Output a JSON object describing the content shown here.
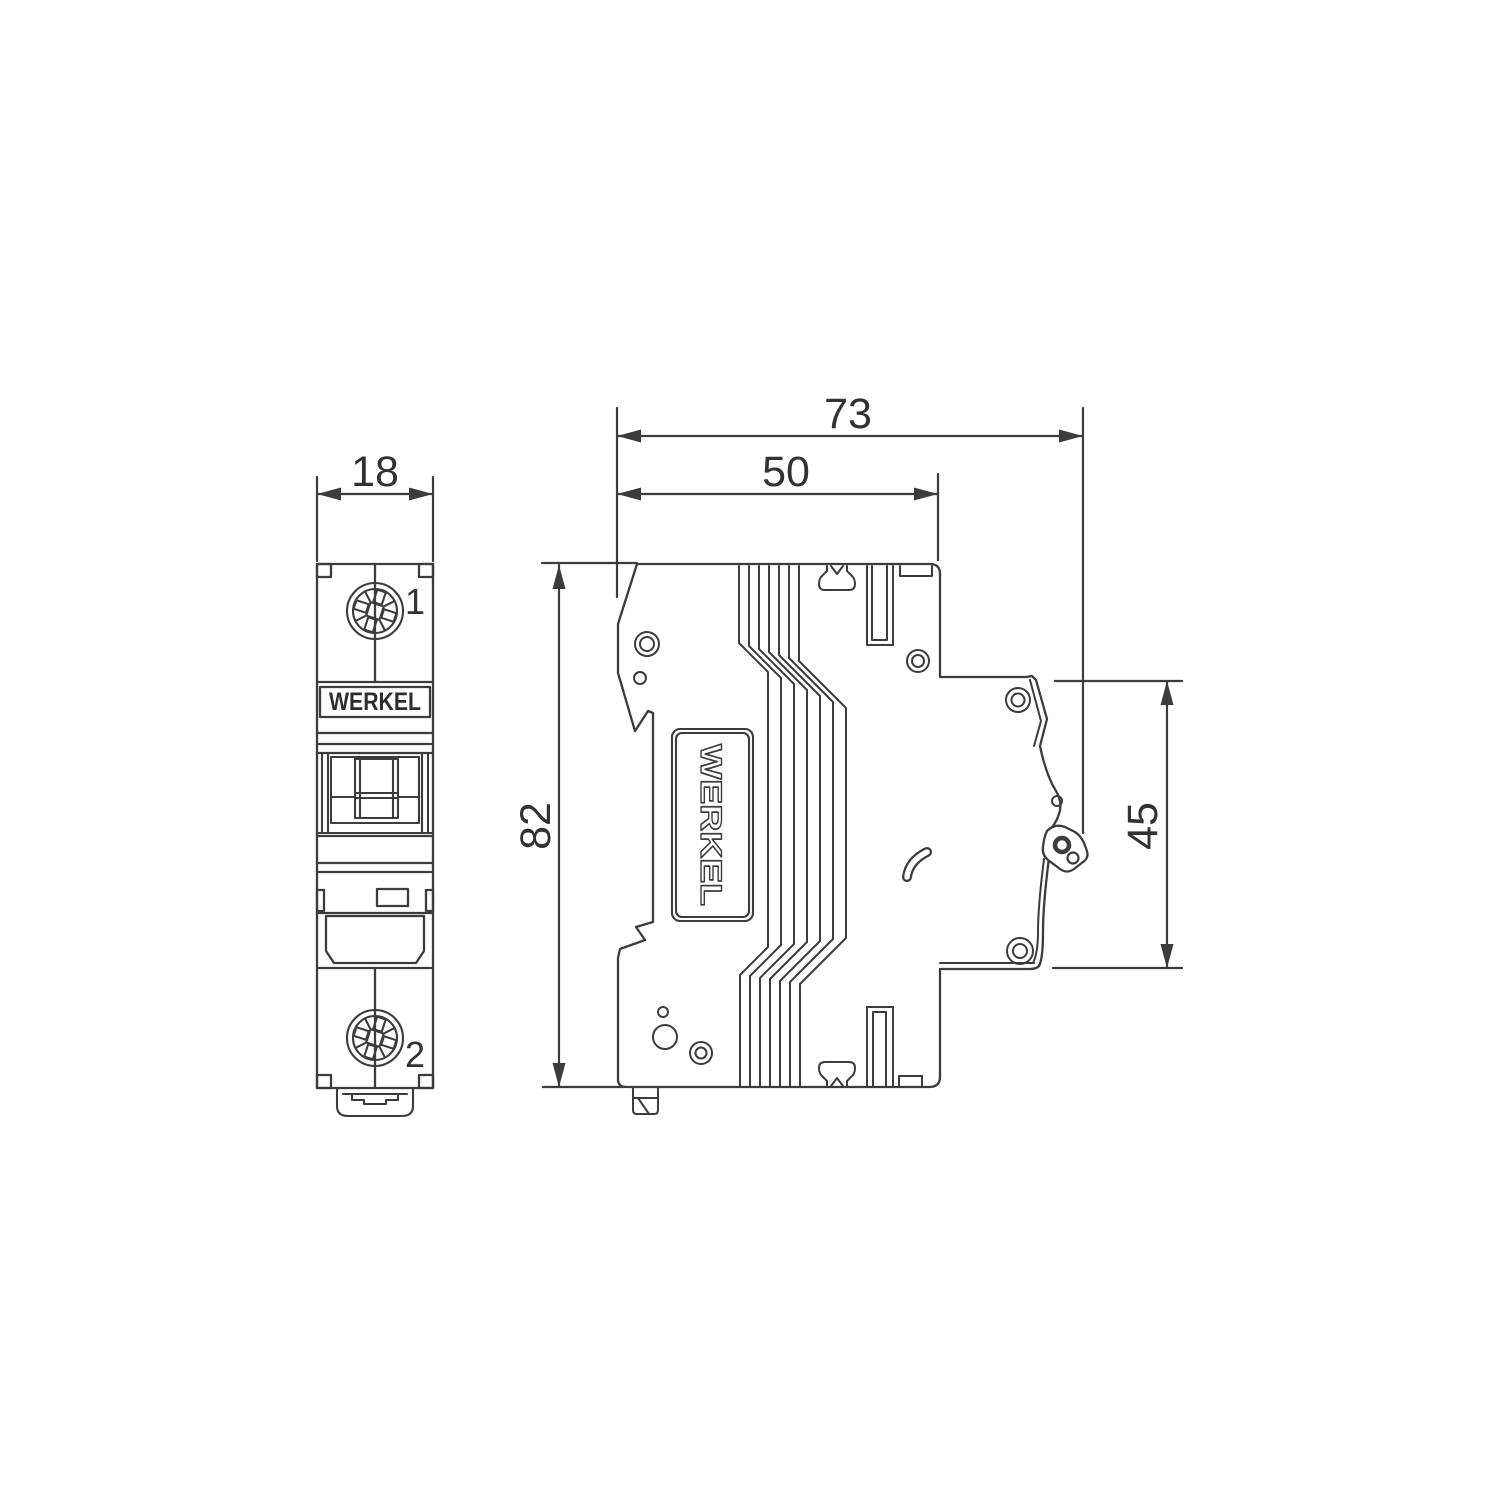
{
  "title": "WERKEL modular circuit breaker dimensional drawing",
  "brand": "WERKEL",
  "colors": {
    "line": "#3c3c3c",
    "text": "#323232",
    "background": "#ffffff"
  },
  "front_view": {
    "logo": "WERKEL",
    "terminal_top_label": "1",
    "terminal_bottom_label": "2"
  },
  "side_view": {
    "label": "WERKEL"
  },
  "dimensions": {
    "front_width_mm": "18",
    "overall_depth_mm": "73",
    "body_depth_mm": "50",
    "height_mm": "82",
    "mount_height_mm": "45"
  }
}
